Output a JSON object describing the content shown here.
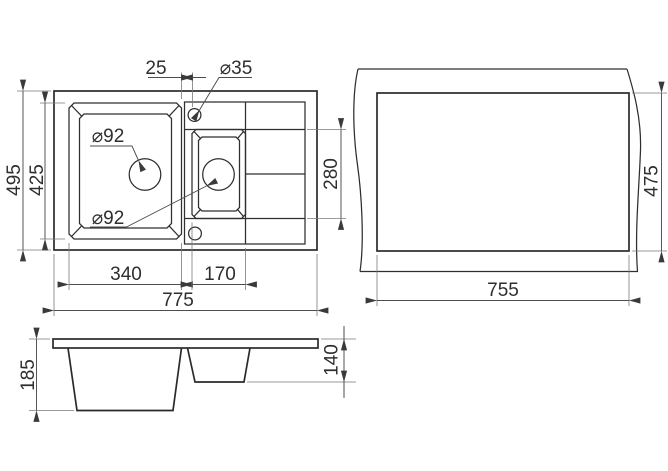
{
  "meta": {
    "background_color": "#ffffff",
    "line_color": "#2a2a2a",
    "dimension_line_color": "#4d4d4d",
    "text_color": "#2e2e2e"
  },
  "plan_view": {
    "dims": {
      "bowl_gap": "25",
      "tap_hole_diameter": "⌀35",
      "overall_depth": "495",
      "main_bowl_depth": "425",
      "main_drain_diameter": "⌀92",
      "small_drain_diameter": "⌀92",
      "main_bowl_width": "340",
      "small_bowl_width": "170",
      "overall_width": "775",
      "small_bowl_inner_depth": "280"
    }
  },
  "cutout_view": {
    "dims": {
      "cutout_depth": "475",
      "cutout_width": "755"
    }
  },
  "front_view": {
    "dims": {
      "overall_height": "185",
      "small_bowl_height": "140"
    }
  }
}
